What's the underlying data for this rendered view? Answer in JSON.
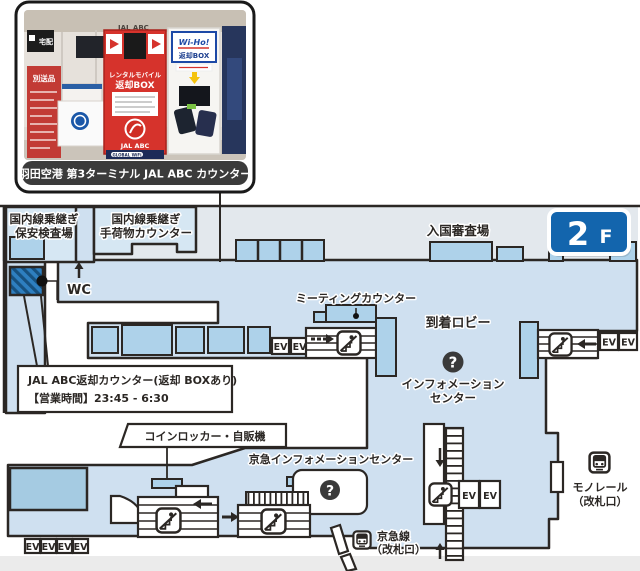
{
  "photo": {
    "caption": "羽田空港 第3ターミナル JAL ABC カウンター",
    "signs": {
      "takuhai": "宅配",
      "bessohin": "別送品",
      "ceiling": "JAL ABC",
      "rental_l1": "レンタルモバイル",
      "rental_l2": "返却BOX",
      "jal_abc": "JAL ABC",
      "global_wifi": "GLOBAL WiFi",
      "wiho": "Wi-Ho!",
      "wiho_box": "返却BOX"
    }
  },
  "map": {
    "floor_badge": {
      "number": "2",
      "suffix": "F"
    },
    "labels": {
      "security_l1": "国内線乗継ぎ",
      "security_l2": "保安検査場",
      "baggage_l1": "国内線乗継ぎ",
      "baggage_l2": "手荷物カウンター",
      "immigration": "入国審査場",
      "wc": "WC",
      "meeting_counter": "ミーティングカウンター",
      "arrival_lobby": "到着ロビー",
      "info_l1": "インフォメーション",
      "info_l2": "センター",
      "question": "?",
      "callout_l1": "JAL ABC返却カウンター(返却 BOXあり)",
      "callout_l2": "【営業時間】23:45 - 6:30",
      "coin_locker": "コインロッカー・自販機",
      "keikyu_info": "京急インフォメーションセンター",
      "keikyu_l1": "京急線",
      "keikyu_l2": "（改札口）",
      "monorail_l1": "モノレール",
      "monorail_l2": "（改札口）",
      "ev": "EV"
    },
    "colors": {
      "floor": "#cfe0f0",
      "upper_band": "#e3e8ed",
      "booth_blue": "#aed2ea",
      "room_blue": "#a5cbe2",
      "wall": "#2b2724",
      "jal_highlight": "#2e7fc0",
      "badge_blue": "#1365ad",
      "caption_bg": "#3b3b3b",
      "kiosk_red": "#d6332c",
      "wiho_blue": "#1d49a6"
    }
  }
}
